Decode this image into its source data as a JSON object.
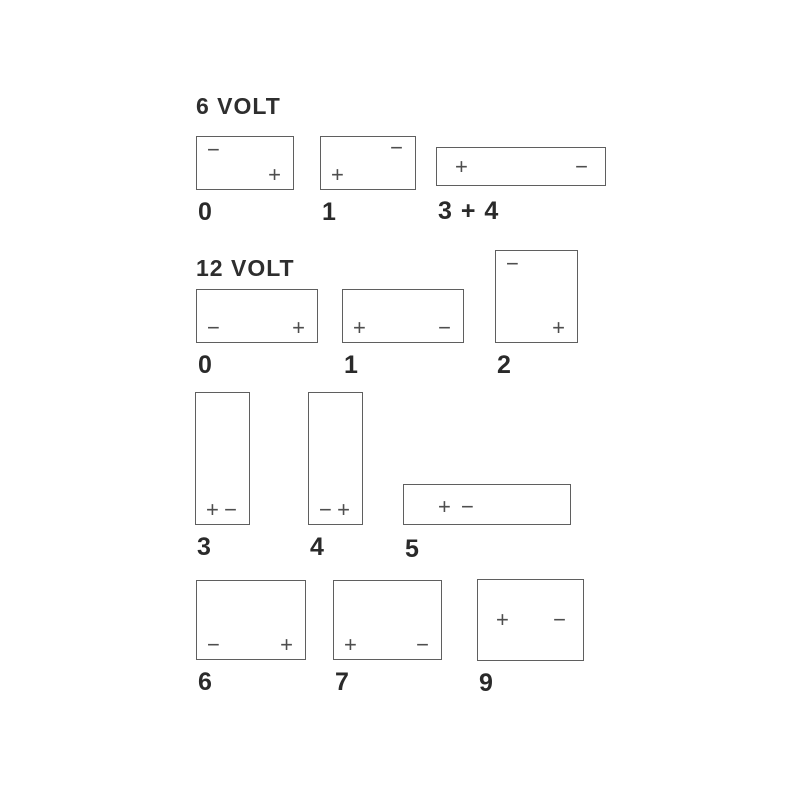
{
  "diagram_title": "Battery terminal layout codes",
  "colors": {
    "background": "#ffffff",
    "box_line": "#5f5f5f",
    "symbol": "#4e4e4e",
    "text": "#2a2a2a"
  },
  "symbols": {
    "positive": "+",
    "negative": "−"
  },
  "sections": [
    {
      "heading": "6 VOLT",
      "batteries": [
        {
          "label": "0",
          "terminals": [
            {
              "symbol": "−",
              "pos": "tl"
            },
            {
              "symbol": "+",
              "pos": "br"
            }
          ]
        },
        {
          "label": "1",
          "terminals": [
            {
              "symbol": "−",
              "pos": "tr"
            },
            {
              "symbol": "+",
              "pos": "bl"
            }
          ]
        },
        {
          "label": "3 + 4",
          "terminals": [
            {
              "symbol": "+",
              "pos": "ml"
            },
            {
              "symbol": "−",
              "pos": "mr"
            }
          ]
        }
      ]
    },
    {
      "heading": "12 VOLT",
      "batteries": [
        {
          "label": "0",
          "terminals": [
            {
              "symbol": "−",
              "pos": "bl"
            },
            {
              "symbol": "+",
              "pos": "br"
            }
          ]
        },
        {
          "label": "1",
          "terminals": [
            {
              "symbol": "+",
              "pos": "bl"
            },
            {
              "symbol": "−",
              "pos": "br"
            }
          ]
        },
        {
          "label": "2",
          "terminals": [
            {
              "symbol": "−",
              "pos": "tl"
            },
            {
              "symbol": "+",
              "pos": "br"
            }
          ]
        },
        {
          "label": "3",
          "terminals": [
            {
              "symbol": "+",
              "pos": "bl"
            },
            {
              "symbol": "−",
              "pos": "br"
            }
          ]
        },
        {
          "label": "4",
          "terminals": [
            {
              "symbol": "−",
              "pos": "bl"
            },
            {
              "symbol": "+",
              "pos": "br"
            }
          ]
        },
        {
          "label": "5",
          "terminals": [
            {
              "symbol": "+",
              "pos": "ml2"
            },
            {
              "symbol": "−",
              "pos": "ml3"
            }
          ]
        },
        {
          "label": "6",
          "terminals": [
            {
              "symbol": "−",
              "pos": "bl"
            },
            {
              "symbol": "+",
              "pos": "br"
            }
          ]
        },
        {
          "label": "7",
          "terminals": [
            {
              "symbol": "+",
              "pos": "bl"
            },
            {
              "symbol": "−",
              "pos": "br"
            }
          ]
        },
        {
          "label": "9",
          "terminals": [
            {
              "symbol": "+",
              "pos": "ml"
            },
            {
              "symbol": "−",
              "pos": "mr"
            }
          ]
        }
      ]
    }
  ]
}
